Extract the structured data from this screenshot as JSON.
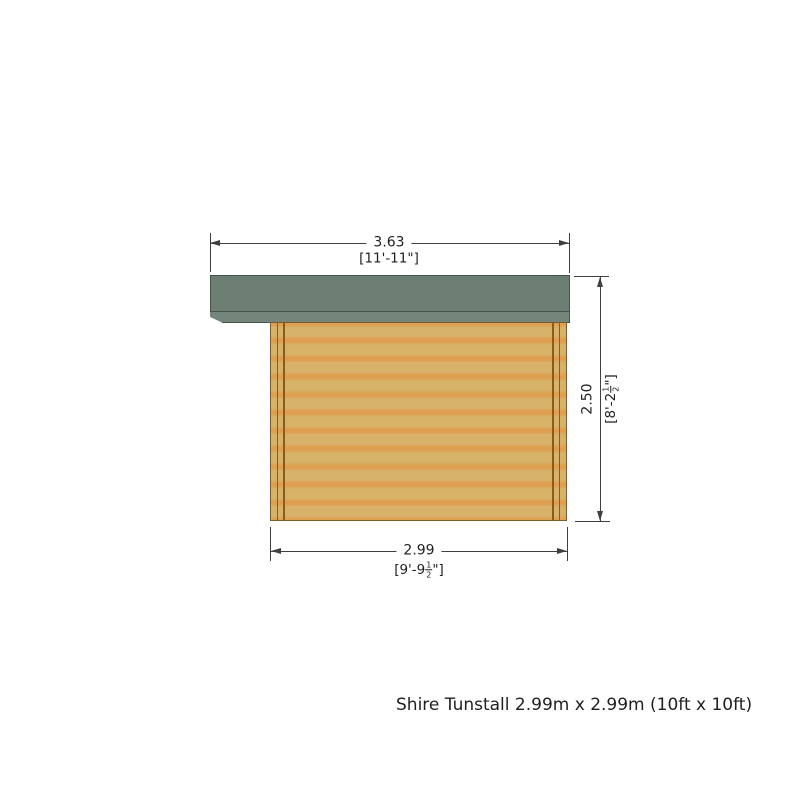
{
  "drawing": {
    "caption": "Shire Tunstall 2.99m x 2.99m (10ft x 10ft)",
    "dimensions": {
      "overall_width": {
        "metric": "3.63",
        "imperial": "[11'-11\"]"
      },
      "wall_width": {
        "metric": "2.99",
        "imperial_prefix": "[9'-9",
        "fraction_numerator": "1",
        "fraction_denominator": "2",
        "imperial_suffix": "\"]"
      },
      "wall_height": {
        "metric": "2.50",
        "imperial_prefix": "[8'-2",
        "fraction_numerator": "1",
        "fraction_denominator": "2",
        "imperial_suffix": "\"]"
      }
    },
    "colors": {
      "roof": "#6d7f73",
      "roof_fascia": "#74867c",
      "roof_outline": "#45544a",
      "wall_light": "#d7b269",
      "wall_stripe": "#df9f51",
      "wall_trim": "#8a5a1e",
      "wall_outline": "#7c5c28",
      "dim_line": "#3f3f3f",
      "text_color": "#1f1f1f"
    }
  }
}
